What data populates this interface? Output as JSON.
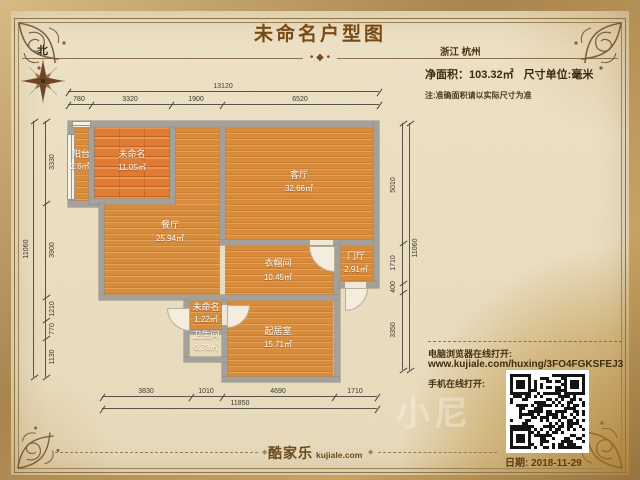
{
  "header": {
    "title": "未命名户型图",
    "ornament": "• ◆ •",
    "region": "浙江 杭州",
    "net_area_label": "净面积：",
    "net_area_value": "103.32㎡",
    "unit_label": "尺寸单位:毫米",
    "note": "注:准确面积请以实际尺寸为准"
  },
  "compass": {
    "north_label": "北"
  },
  "rooms": [
    {
      "name": "阳台",
      "area": "2.6㎡"
    },
    {
      "name": "未命名",
      "area": "11.05㎡"
    },
    {
      "name": "餐厅",
      "area": "25.94㎡"
    },
    {
      "name": "客厅",
      "area": "32.66㎡"
    },
    {
      "name": "衣帽间",
      "area": "10.45㎡"
    },
    {
      "name": "门厅",
      "area": "2.91㎡"
    },
    {
      "name": "未命名",
      "area": "1.22㎡"
    },
    {
      "name": "卫生间",
      "area": "0.78㎡"
    },
    {
      "name": "起居室",
      "area": "15.71㎡"
    }
  ],
  "dims": {
    "top_total": "13120",
    "top": [
      "780",
      "3320",
      "1900",
      "6520"
    ],
    "bottom": [
      "3830",
      "1010",
      "4690",
      "1710"
    ],
    "bottom_total": "11850",
    "left": [
      "3330",
      "3900",
      "1210",
      "770",
      "1130"
    ],
    "left_total": "11060",
    "right": [
      "5010",
      "1710",
      "400",
      "3350"
    ],
    "right_total": "11060"
  },
  "share": {
    "desktop_label": "电脑浏览器在线打开:",
    "url": "www.kujiale.com/huxing/3FO4FGKSFEJ3",
    "mobile_label": "手机在线打开:",
    "watermark": "小尼"
  },
  "footer": {
    "brand_cn": "酷家乐",
    "brand_en": "kujiale.com",
    "date": "日期: 2018-11-29"
  },
  "colors": {
    "parchment": "#ece0c3",
    "gold": "#c59a55",
    "wall_gray": "#a4a19a",
    "floor_orange": "#d78b3b",
    "plank_orange": "#e07b33",
    "title_brown": "#7a4a14"
  }
}
